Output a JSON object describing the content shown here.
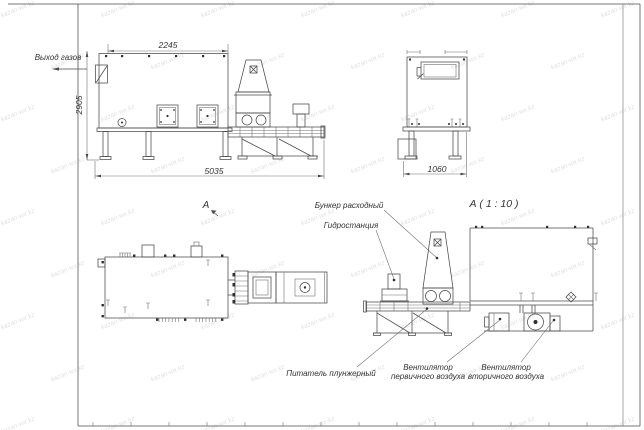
{
  "labels": {
    "gas_outlet": "Выход газов",
    "view_marker": "А",
    "detail_title": "А ( 1 : 10 )",
    "feed_hopper": "Бункер расходный",
    "hydraulic_station": "Гидростанция",
    "plunger_feeder": "Питатель плунжерный",
    "primary_fan": [
      "Вентилятор",
      "первичного воздуха"
    ],
    "secondary_fan": [
      "Вентилятор",
      "вторичного воздуха"
    ]
  },
  "dimensions": {
    "upper_width": "2245",
    "height": "2905",
    "total_length": "5035",
    "side_width": "1060"
  },
  "watermark": {
    "text": "kazan-wx.kz"
  },
  "colors": {
    "line": "#4a4a4a",
    "text": "#333333",
    "watermark": "#e2e2e2",
    "background": "#ffffff"
  }
}
